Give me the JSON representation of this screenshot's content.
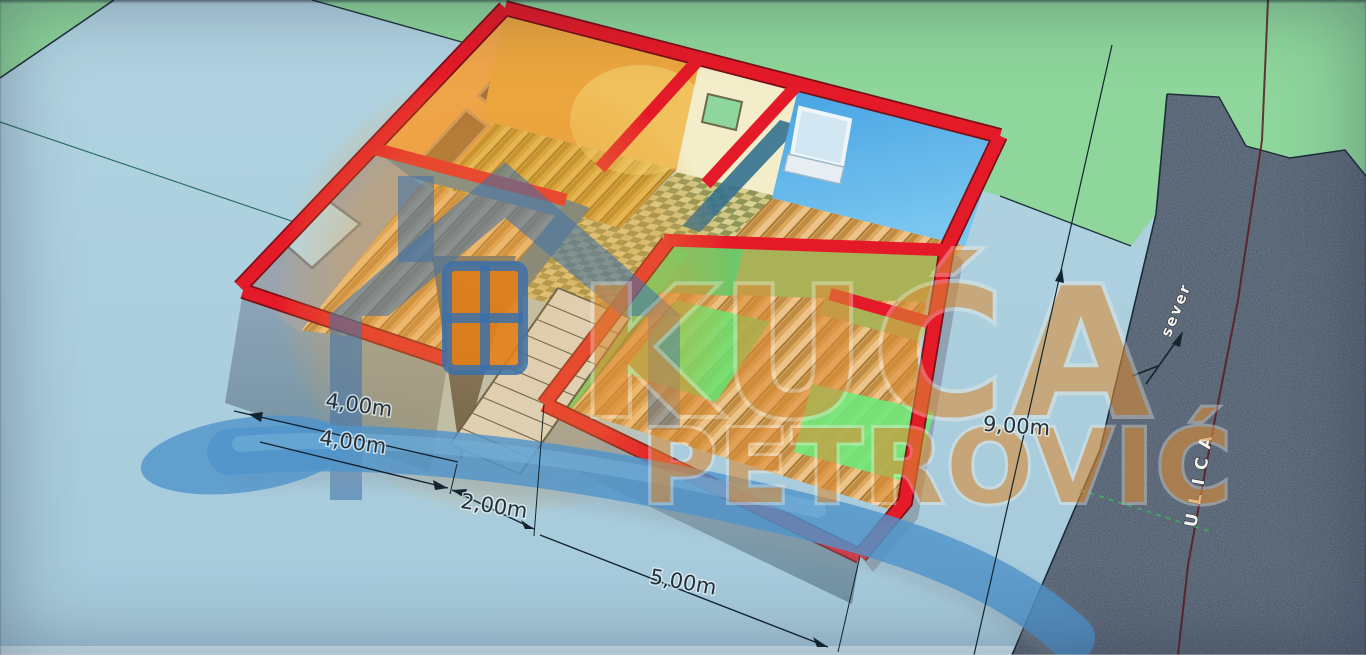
{
  "watermark": {
    "line1": "KUĆA",
    "line2": "PETROVIĆ"
  },
  "dims": {
    "d1": "4,00m",
    "d2": "4,00m",
    "d3": "2,00m",
    "d4": "5,00m",
    "d5": "9,00m"
  },
  "street": {
    "name": "ULICA",
    "north": "sever"
  },
  "colors": {
    "wall_top_red": "#e51a28",
    "grass_green": "#8ed69b",
    "plot_blue": "#a9cfdf",
    "street_asphalt": "#46566a",
    "logo_orange": "#db8c36",
    "swoosh_blue": "#4f94cb"
  }
}
